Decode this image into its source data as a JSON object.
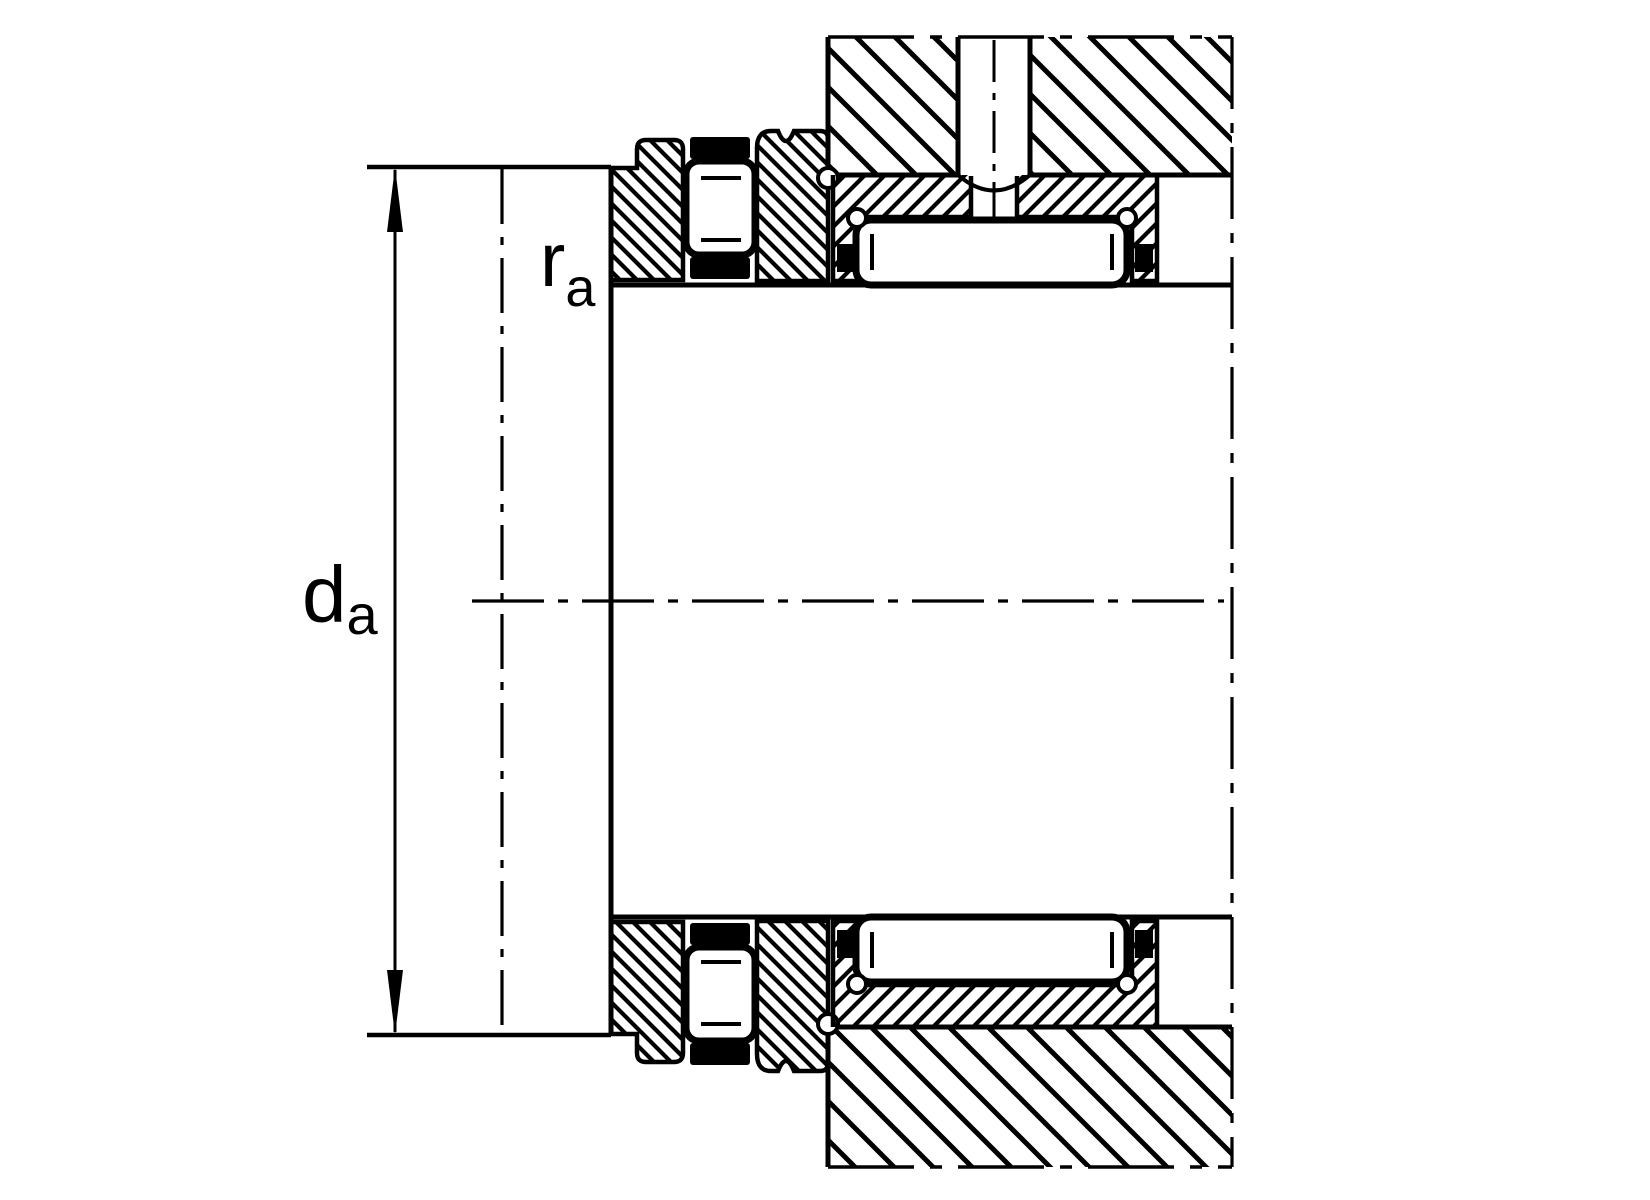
{
  "figure": {
    "kind": "bearing-mounting-cross-section",
    "labels": {
      "abutment_diameter": {
        "main": "d",
        "sub": "a"
      },
      "fillet_radius": {
        "main": "r",
        "sub": "a"
      }
    },
    "colors": {
      "line": "#000000",
      "background": "#ffffff"
    },
    "parts": [
      "shaft-shoulder",
      "thrust-washer",
      "axial-roller-and-cage",
      "centering-ring",
      "radial-needle-roller",
      "bearing-outer-ring",
      "housing",
      "lubrication-channel",
      "dimension-arrow"
    ]
  }
}
